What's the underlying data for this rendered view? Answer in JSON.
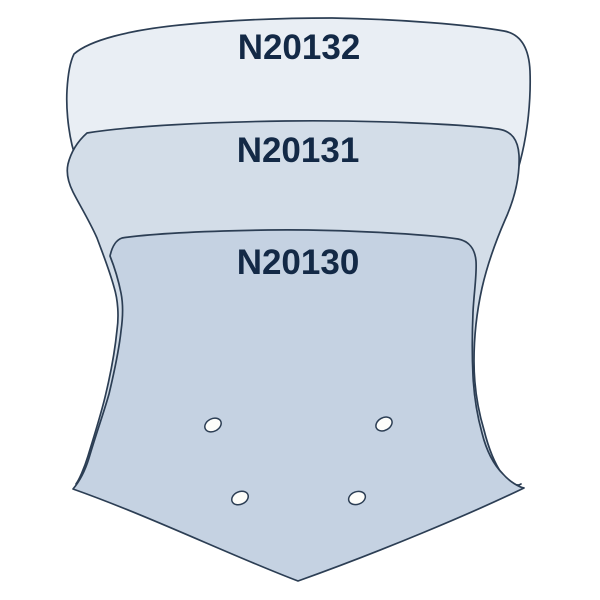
{
  "diagram": {
    "name": "Windscreen size comparison diagram",
    "background": "#ffffff",
    "outline_color": "#2c3e54",
    "label_color": "#132946",
    "hole_fill": "#fdfdfa",
    "shapes": [
      {
        "code": "N20132",
        "size": "large",
        "fill": "#e9eef4"
      },
      {
        "code": "N20131",
        "size": "medium",
        "fill": "#d3dde8"
      },
      {
        "code": "N20130",
        "size": "small",
        "fill": "#c5d2e2",
        "mounting_holes": 4
      }
    ]
  }
}
